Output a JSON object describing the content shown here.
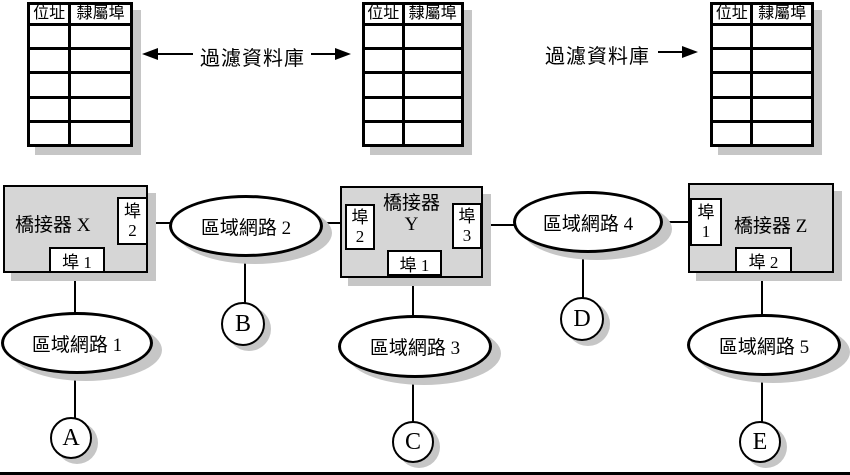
{
  "tables": {
    "headers": [
      "位址",
      "隸屬埠"
    ],
    "row_count": 5
  },
  "filter_db": {
    "label_left": "過濾資料庫",
    "label_right": "過濾資料庫"
  },
  "bridges": {
    "x": {
      "label": "橋接器 X",
      "port_right_char": "埠",
      "port_right_num": "2",
      "port_bottom_label": "埠 1"
    },
    "y": {
      "label_line1": "橋接器",
      "label_line2": "Y",
      "port_left_char": "埠",
      "port_left_num": "2",
      "port_right_char": "埠",
      "port_right_num": "3",
      "port_bottom_label": "埠 1"
    },
    "z": {
      "label": "橋接器 Z",
      "port_left_char": "埠",
      "port_left_num": "1",
      "port_bottom_label": "埠 2"
    }
  },
  "lans": {
    "lan1": "區域網路 1",
    "lan2": "區域網路 2",
    "lan3": "區域網路 3",
    "lan4": "區域網路 4",
    "lan5": "區域網路 5"
  },
  "stations": {
    "a": "A",
    "b": "B",
    "c": "C",
    "d": "D",
    "e": "E"
  },
  "colors": {
    "bridge_fill": "#d6d6d6",
    "shadow": "#c6c6c6",
    "line": "#000000",
    "background": "#ffffff"
  }
}
